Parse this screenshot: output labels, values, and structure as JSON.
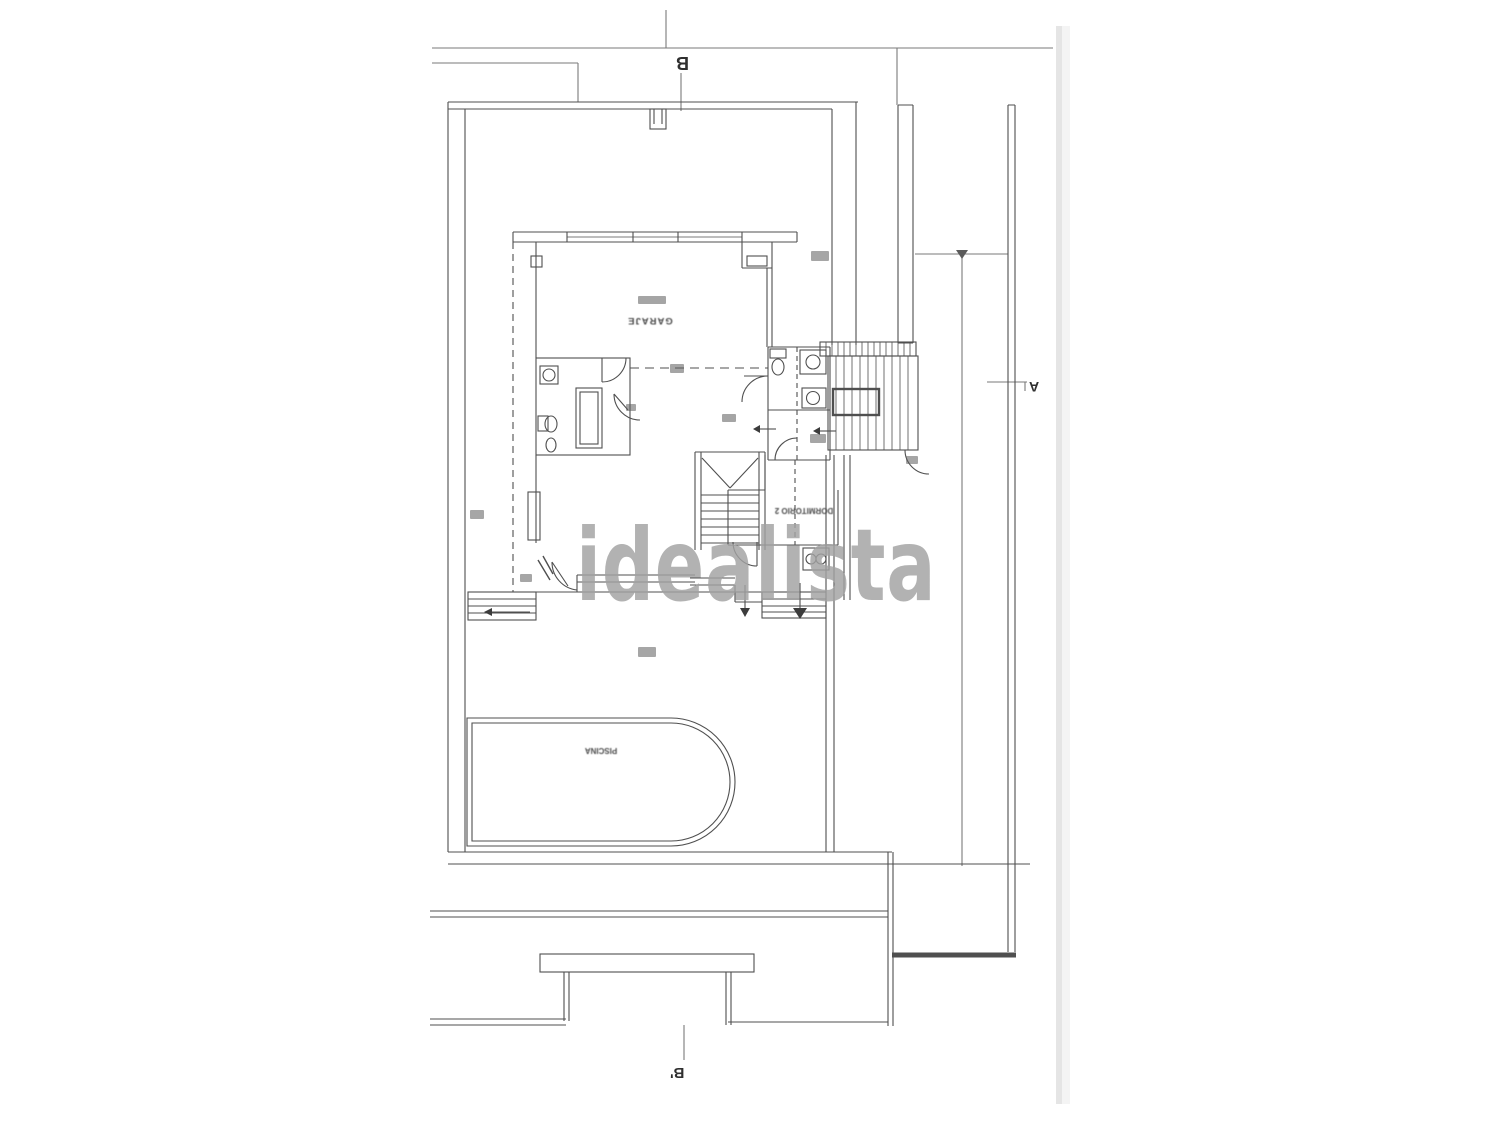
{
  "document": {
    "kind": "scanned architectural floor plan",
    "orientation": "plan printed upside-down (rotated 180°)"
  },
  "watermark": {
    "text": "idealista",
    "color": "#a2a2a2"
  },
  "markers": {
    "b": "B",
    "a": "A",
    "b_prime": "B'"
  },
  "rooms": {
    "garage": "GARAJE",
    "bedroom2": "DORMITORIO 2",
    "pool": "PISCINA"
  },
  "features": [
    "main-staircase",
    "exterior-staircase",
    "bathroom-fixtures",
    "wc-fixtures",
    "swimming-pool",
    "terrace-steps",
    "driveway-gate",
    "section-line-B-B",
    "section-line-A"
  ],
  "colors": {
    "background": "#ffffff",
    "ink": "#4f4f4f",
    "boundary": "#7a7a7a",
    "scan_edge": "#cccccc"
  }
}
